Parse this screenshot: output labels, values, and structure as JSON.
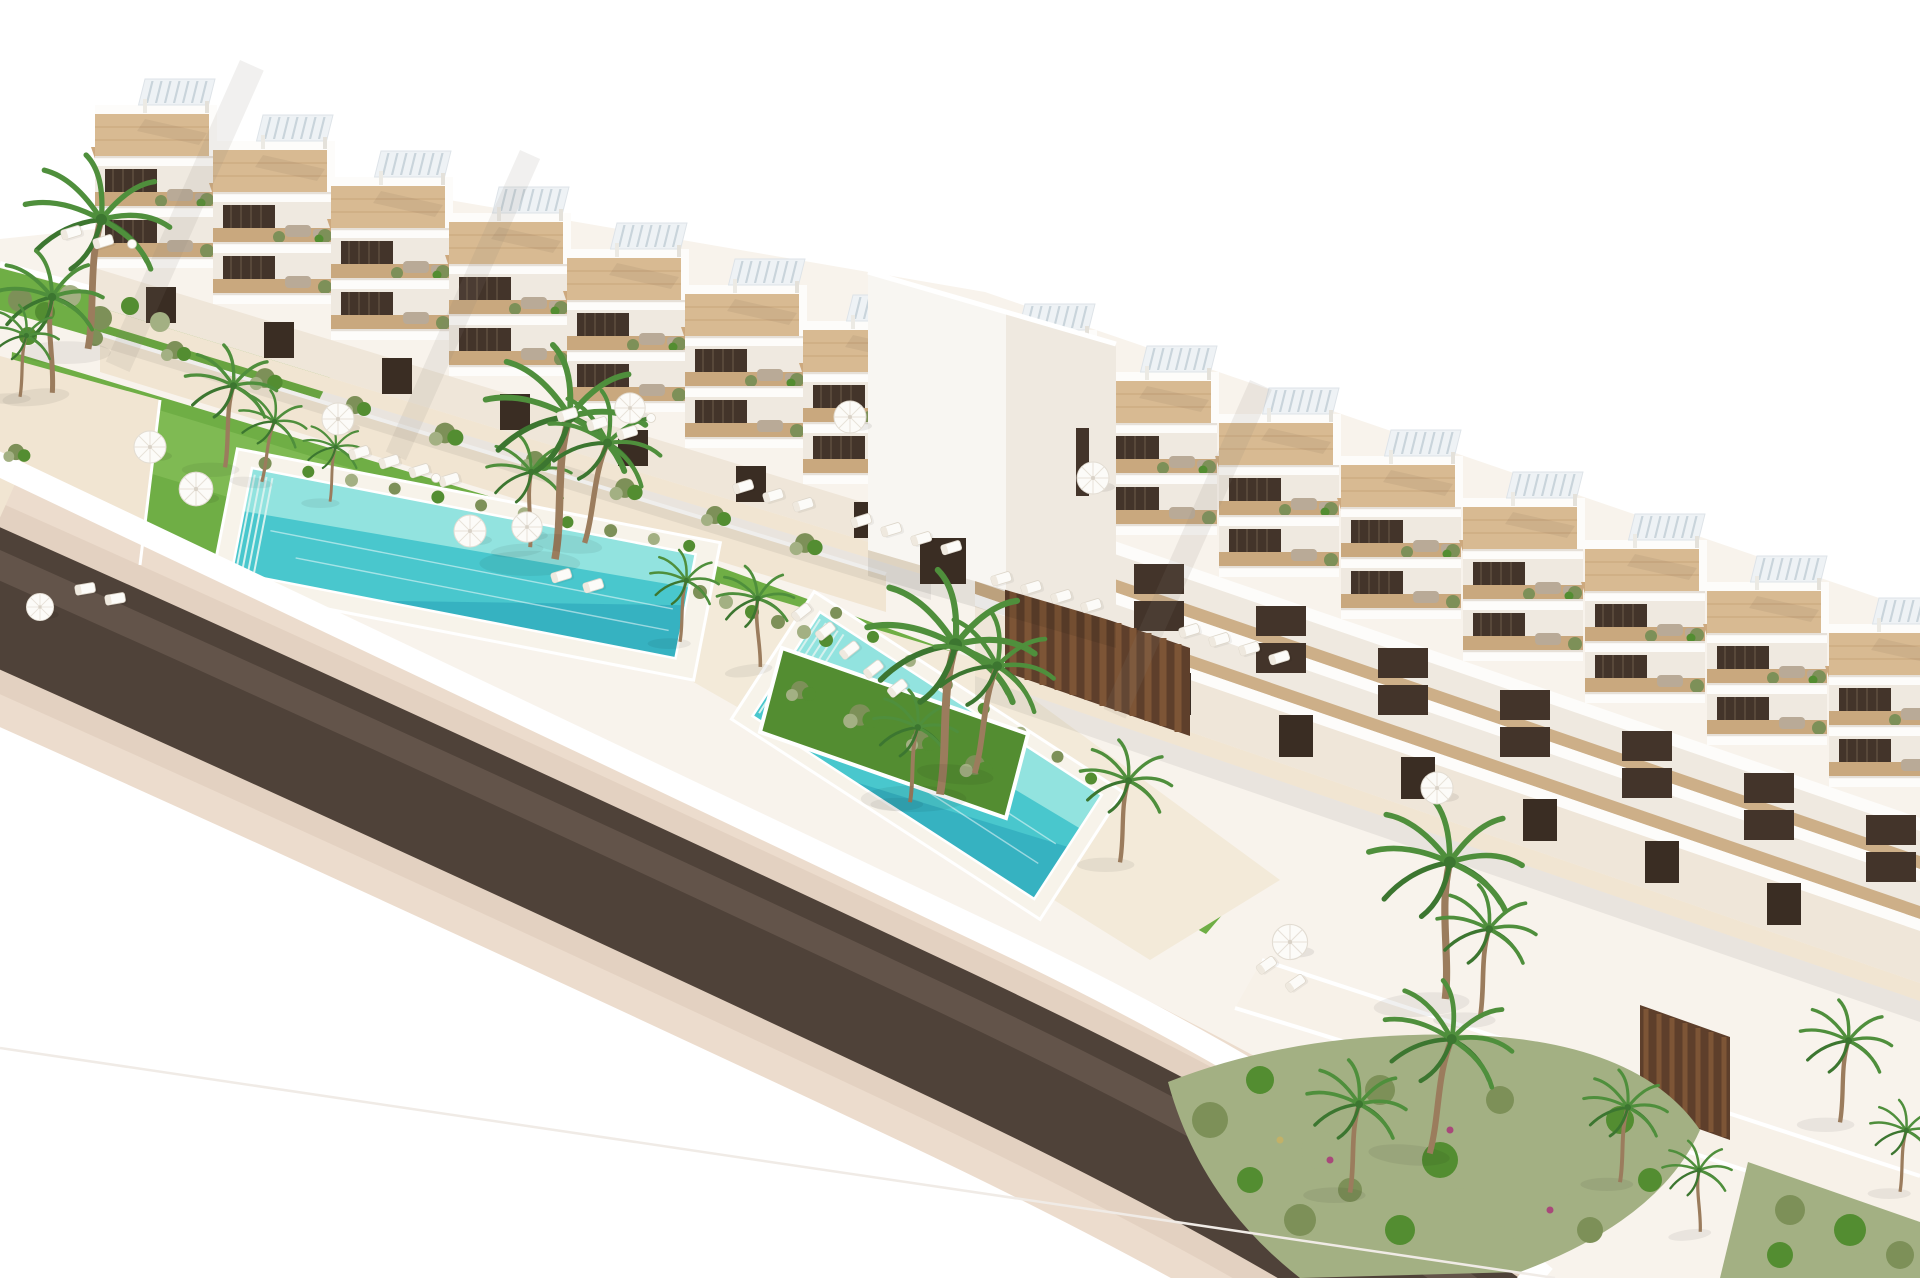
{
  "scene": {
    "type": "architectural-3d-render",
    "description": "Aerial rendering of a white terraced apartment complex: two stepped residential blocks with rooftop pergola terraces and wooden decks, balconies with loungers, external staircases, two turquoise swimming pools, green lawns with white parasols and sun loungers, palm trees, planted garden beds and a dark curved access road with sandy shoulders on a white background.",
    "background": "#ffffff"
  },
  "site": {
    "buildings": [
      {
        "name": "terraced block A",
        "units_visible": 7,
        "levels_visible": 4,
        "features": [
          "rooftop pergolas",
          "wood deck terraces",
          "balconies with planters",
          "external staircases"
        ]
      },
      {
        "name": "terraced block B",
        "units_visible": 8,
        "levels_visible": 5,
        "features": [
          "rooftop pergolas",
          "wood deck terraces",
          "balconies with planters",
          "external staircases",
          "dark wood feature walls"
        ]
      },
      {
        "name": "link tower",
        "units_visible": 1,
        "levels_visible": 3,
        "features": [
          "window slit",
          "entrance door"
        ]
      }
    ],
    "pools": [
      {
        "name": "main pool",
        "shape": "long rectangle",
        "edge_planting": true
      },
      {
        "name": "second pool",
        "shape": "long rectangle",
        "edge_planting": true
      }
    ],
    "amenities": {
      "parasols": 11,
      "sun_loungers": 35,
      "side_tables": 3,
      "palm_trees": 23,
      "planting_beds": 6,
      "facade_planter_clusters": 8
    },
    "road": {
      "name": "curved access road",
      "surface": "dark asphalt",
      "shoulders": "sand",
      "perimeter_wall": "white"
    }
  },
  "colors": {
    "background": "#ffffff",
    "building_white": "#f8f6f2",
    "parapet_white": "#fdfcfa",
    "building_shade": "#efe9e0",
    "wall_beige": "#efe6d9",
    "deck_wood": "#d8ba92",
    "deck_wood_dark": "#c9a87e",
    "window_dark": "#43342a",
    "door_dark": "#3a2d23",
    "pergola_white": "#eef2f5",
    "stair_tan": "#cda97e",
    "grass": "#6fae45",
    "grass_dark": "#538d31",
    "grass_light": "#8cc45f",
    "shrub_olive": "#7d9058",
    "shrub_sage": "#a3b083",
    "palm_green": "#4f8f3c",
    "palm_dark": "#3c7630",
    "trunk_brown": "#9b7c5d",
    "sand_path": "#f1e5d2",
    "sand_light": "#f7f1e8",
    "terrace_pale": "#f3ead9",
    "pool_aqua": "#49c7cd",
    "pool_light": "#9fe7e2",
    "pool_deep": "#2fa9bc",
    "road_dark": "#4f4239",
    "road_mid": "#75655a",
    "shoulder_pink": "#decab9",
    "shoulder_light": "#ecdccd",
    "white_wall": "#ffffff",
    "furniture_gray": "#b9aa97",
    "umbrella_white": "#fcfbf8",
    "feature_wood": "#5e3f2b"
  }
}
